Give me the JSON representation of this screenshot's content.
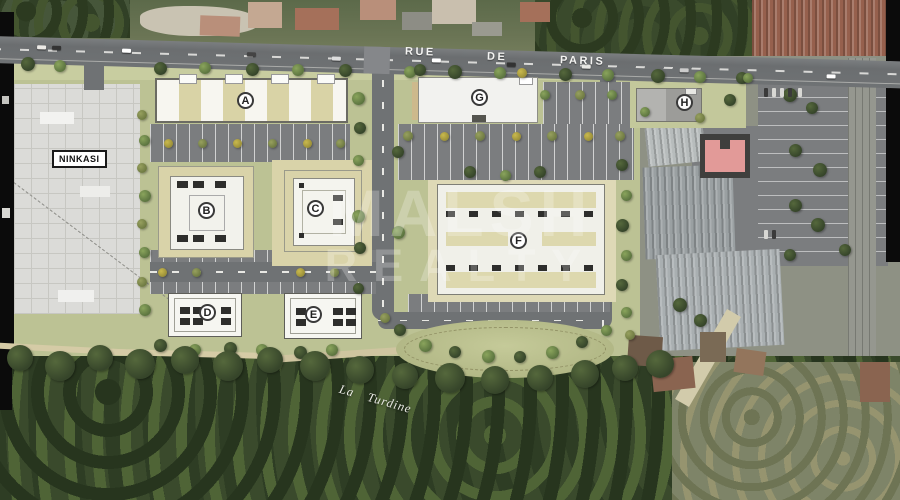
{
  "street": {
    "name": "RUE DE PARIS",
    "words": [
      "RUE",
      "DE",
      "PARIS"
    ]
  },
  "labels": {
    "site": "NINKASI",
    "river": "La Turdine"
  },
  "watermark": {
    "line1": "MALSH",
    "line2": "REALTY"
  },
  "buildings": [
    {
      "label": "A"
    },
    {
      "label": "B"
    },
    {
      "label": "C"
    },
    {
      "label": "D"
    },
    {
      "label": "E"
    },
    {
      "label": "F"
    },
    {
      "label": "G"
    },
    {
      "label": "H"
    }
  ],
  "colors": {
    "lawn": "#bcc294",
    "road": "#6f7274",
    "parking": "#7b7d7f",
    "tan_apron": "#d8d2a8",
    "building_white": "#f0f0e9",
    "sport_court_red": "#e29a98",
    "canopy_green": "#3a4a2c"
  }
}
